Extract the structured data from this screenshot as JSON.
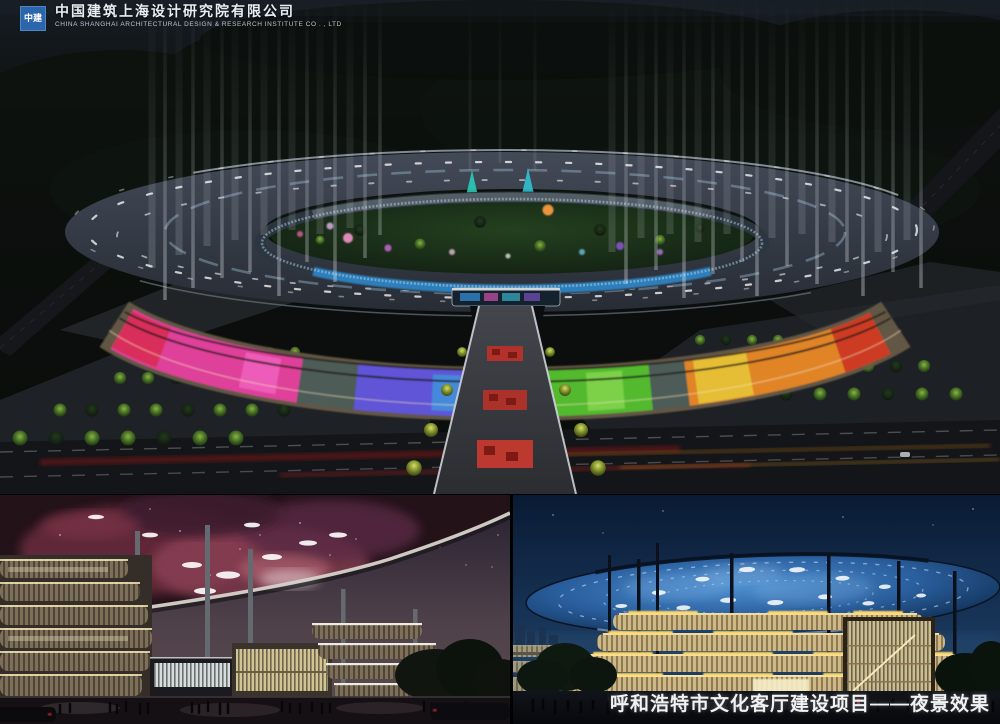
{
  "header": {
    "logo_text": "中建",
    "logo_color": "#2b66ad",
    "company_name_cn": "中国建筑上海设计研究院有限公司",
    "company_name_en": "CHINA SHANGHAI ARCHITECTURAL DESIGN & RESEARCH INSTITUTE CO . , LTD"
  },
  "caption": {
    "text": "呼和浩特市文化客厅建设项目——夜景效果"
  },
  "palette": {
    "facade_pink": "#df3f9a",
    "facade_purple": "#5f54d6",
    "facade_green": "#53b92f",
    "facade_orange": "#e08428",
    "inner_ring_blue": "#2f86c8",
    "nebula_canopy_pink": "#93445a",
    "dome_starry_blue": "#2a5f9e",
    "night_sky_blue": "#0a1a33"
  }
}
